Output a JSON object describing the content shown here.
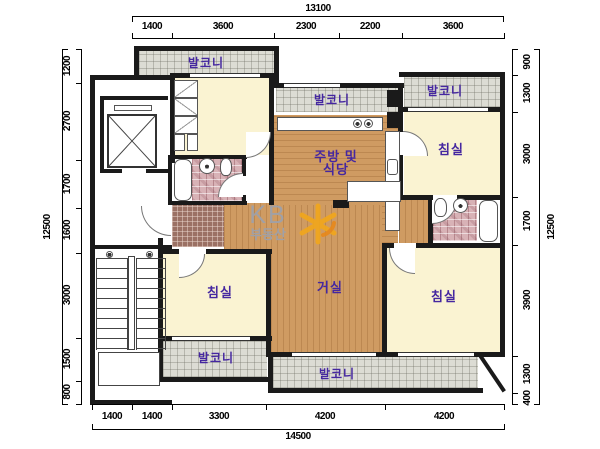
{
  "rooms": {
    "balcony_top_left": {
      "label": "발코니"
    },
    "balcony_top_middle": {
      "label": "발코니"
    },
    "balcony_top_right": {
      "label": "발코니"
    },
    "balcony_bottom_left": {
      "label": "발코니"
    },
    "balcony_bottom_middle": {
      "label": "발코니"
    },
    "bedroom_top_right": {
      "label": "침실"
    },
    "bedroom_bottom_left": {
      "label": "침실"
    },
    "bedroom_bottom_right": {
      "label": "침실"
    },
    "living": {
      "label": "거실"
    },
    "kitchen": {
      "label_line1": "주방 및",
      "label_line2": "식당"
    }
  },
  "watermark": {
    "brand": "KB",
    "sub": "부동산",
    "logo_icon": "kb-star-icon"
  },
  "dimensions": {
    "top": {
      "total": "13100",
      "segments": [
        "1400",
        "3600",
        "2300",
        "2200",
        "3600"
      ]
    },
    "bottom": {
      "total": "14500",
      "segments": [
        "1400",
        "1400",
        "3300",
        "4200",
        "4200"
      ]
    },
    "left": {
      "total": "12500",
      "segments": [
        "1200",
        "2700",
        "1700",
        "1600",
        "3000",
        "1500",
        "800"
      ]
    },
    "right": {
      "total": "12500",
      "segments": [
        "900",
        "1300",
        "3000",
        "1700",
        "3900",
        "1300",
        "400"
      ]
    }
  },
  "colors": {
    "wall": "#1a1a1a",
    "room_label": "#4527a0",
    "wood_floor": "#cf9b62",
    "bedroom_floor": "#faf3d2",
    "balcony_floor": "#dcdcd4",
    "bath_tile": "#d8b2b6",
    "entry_tile": "#9b7164",
    "watermark_gray": "#a0a0a6",
    "logo_yellow": "#f2a71b"
  }
}
